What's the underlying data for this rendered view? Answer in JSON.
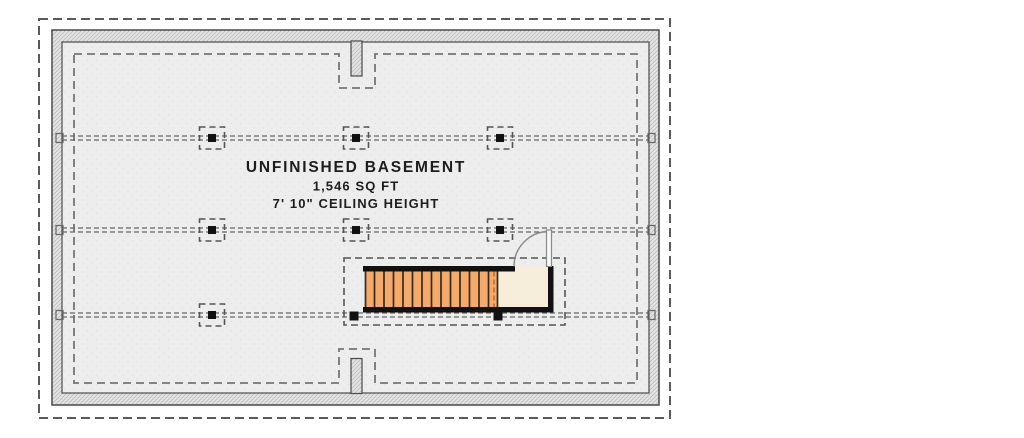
{
  "plan": {
    "title": "UNFINISHED BASEMENT",
    "area": "1,546 SQ FT",
    "ceiling_height": "7' 10\" CEILING HEIGHT"
  },
  "colors": {
    "line": "#4a4a4a",
    "outer_dash": "#5a5a5a",
    "footing_dash": "#757575",
    "beam_dash": "#666666",
    "marker_dash": "#555555",
    "wall_fill": "#e4e4e4",
    "wall_hatch": "#bcbcbc",
    "floor_fill": "#ededed",
    "floor_dot": "#dcdcdc",
    "stair_tread": "#f4aa6a",
    "tread_line": "#3a2a1a",
    "stair_landing": "#f6eeda",
    "stair_dash": "#c9742e",
    "wall_black": "#111111",
    "door_line": "#8a8a8a",
    "text": "#1d1d1d"
  }
}
